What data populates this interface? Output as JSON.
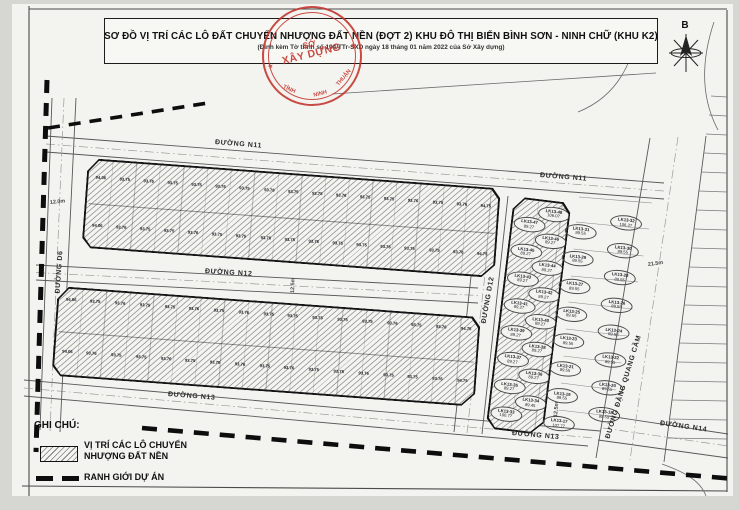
{
  "title": {
    "line1": "SƠ ĐỒ VỊ TRÍ CÁC LÔ ĐẤT CHUYỂN NHƯỢNG ĐẤT NỀN (ĐỢT 2) KHU ĐÔ THỊ BIỂN BÌNH SƠN - NINH CHỮ (KHU K2)",
    "line2": "(Đính kèm Tờ trình số 194/TTr-SXD ngày 18 tháng 01 năm 2022 của Sở Xây dựng)"
  },
  "stamp": {
    "center_top": "SỞ",
    "center_bottom": "XÂY DỰNG",
    "arc_left": "TỈNH",
    "arc_mid": "NINH",
    "arc_right": "THUẬN",
    "star": "★",
    "color": "#c4332b"
  },
  "compass": {
    "label": "B"
  },
  "roads": {
    "n11": "ĐƯỜNG N11",
    "n12": "ĐƯỜNG N12",
    "n13": "ĐƯỜNG N13",
    "n14": "ĐƯỜNG N14",
    "d6": "ĐƯỜNG D6",
    "d12": "ĐƯỜNG D12",
    "dqc": "ĐƯỜNG ĐẶNG QUANG CẦM",
    "w_d6": "12.0m",
    "w_n12": "12.5m",
    "w_n13": "12.5m",
    "w_dqc": "21.5m"
  },
  "legend": {
    "heading": "GHI CHÚ:",
    "item1_line1": "VỊ TRÍ CÁC LÔ CHUYỂN",
    "item1_line2": "NHƯỢNG ĐẤT NỀN",
    "item2": "RANH GIỚI DỰ ÁN"
  },
  "blocks": {
    "strip1": {
      "band_top": [
        "94.06",
        "93.75",
        "93.76",
        "93.75",
        "93.75",
        "93.76",
        "93.75",
        "93.76",
        "93.75",
        "93.75",
        "93.76",
        "93.75",
        "93.75",
        "93.76",
        "93.75",
        "93.76",
        "94.75"
      ],
      "band_bottom": [
        "94.06",
        "93.76",
        "93.75",
        "93.75",
        "93.76",
        "93.75",
        "93.75",
        "93.76",
        "93.75",
        "93.76",
        "93.75",
        "93.75",
        "93.76",
        "93.75",
        "93.75",
        "93.76",
        "94.75"
      ]
    },
    "strip2": {
      "band_top": [
        "94.06",
        "93.75",
        "93.76",
        "93.75",
        "93.75",
        "93.76",
        "93.75",
        "93.76",
        "93.75",
        "93.75",
        "93.76",
        "93.75",
        "93.75",
        "93.76",
        "93.75",
        "93.76",
        "94.75"
      ],
      "band_bottom": [
        "94.06",
        "93.76",
        "93.75",
        "93.75",
        "93.76",
        "93.75",
        "93.75",
        "93.76",
        "93.75",
        "93.76",
        "93.75",
        "93.75",
        "93.76",
        "93.75",
        "93.75",
        "93.76",
        "94.75"
      ]
    },
    "block13_hatched": {
      "lots": [
        {
          "id": "LK13-48",
          "area": "106.07"
        },
        {
          "id": "LK13-47",
          "area": "89.27"
        },
        {
          "id": "LK13-46",
          "area": "89.27"
        },
        {
          "id": "LK13-45",
          "area": "89.27"
        },
        {
          "id": "LK13-44",
          "area": "89.27"
        },
        {
          "id": "LK13-43",
          "area": "89.27"
        },
        {
          "id": "LK13-42",
          "area": "89.27"
        },
        {
          "id": "LK13-41",
          "area": "89.27"
        },
        {
          "id": "LK13-40",
          "area": "89.27"
        },
        {
          "id": "LK13-39",
          "area": "89.27"
        },
        {
          "id": "LK13-38",
          "area": "89.27"
        },
        {
          "id": "LK13-37",
          "area": "89.27"
        },
        {
          "id": "LK13-36",
          "area": "89.27"
        },
        {
          "id": "LK13-35",
          "area": "89.27"
        },
        {
          "id": "LK13-34",
          "area": "89.45"
        },
        {
          "id": "LK13-33",
          "area": "100.77"
        }
      ]
    },
    "block13_open": {
      "lots": [
        {
          "id": "LK13-32",
          "area": "106.37"
        },
        {
          "id": "LK13-31",
          "area": "89.55"
        },
        {
          "id": "LK13-30",
          "area": "89.55"
        },
        {
          "id": "LK13-29",
          "area": "89.55"
        },
        {
          "id": "LK13-28",
          "area": "89.55"
        },
        {
          "id": "LK13-27",
          "area": "89.55"
        },
        {
          "id": "LK13-26",
          "area": "89.55"
        },
        {
          "id": "LK13-25",
          "area": "89.55"
        },
        {
          "id": "LK13-24",
          "area": "89.55"
        },
        {
          "id": "LK13-23",
          "area": "89.55"
        },
        {
          "id": "LK13-22",
          "area": "89.55"
        },
        {
          "id": "LK13-21",
          "area": "89.55"
        },
        {
          "id": "LK13-20",
          "area": "89.55"
        },
        {
          "id": "LK13-19",
          "area": "89.55"
        },
        {
          "id": "LK13-18",
          "area": "89.55"
        },
        {
          "id": "LK13-17",
          "area": "107.77"
        }
      ]
    }
  }
}
